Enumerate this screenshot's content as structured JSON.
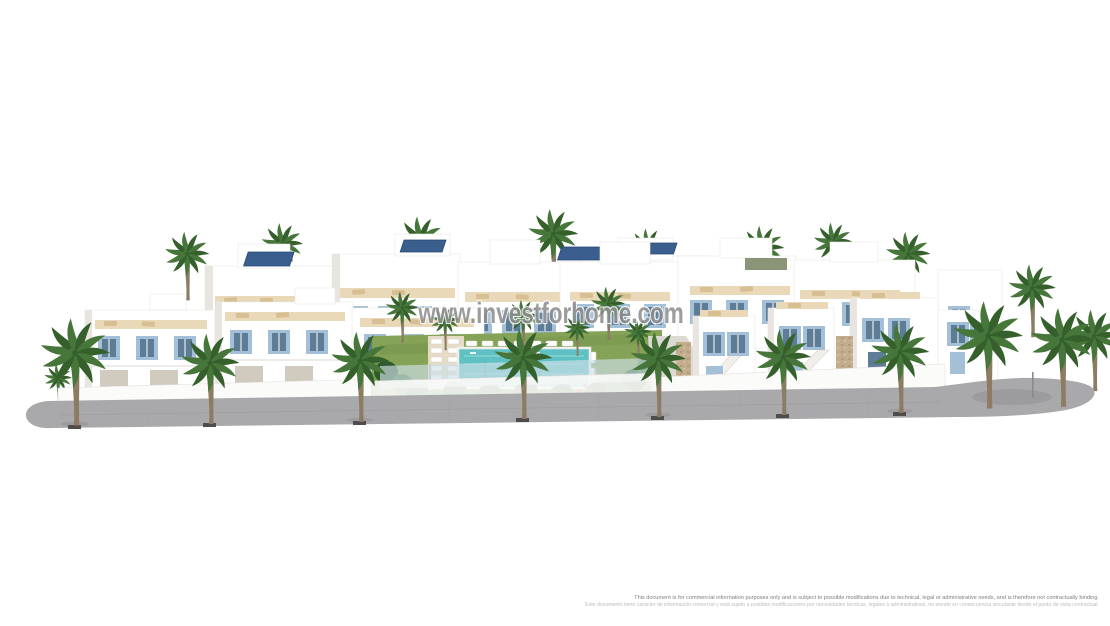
{
  "page": {
    "background": "#ffffff"
  },
  "watermark": {
    "text": "www.investforhome.com"
  },
  "disclaimer": {
    "en": "This document is for commercial information purposes only and is subject to possible modifications due to technical, legal or administrative needs, and is therefore not contractually binding.",
    "es": "Este documento tiene carácter de información comercial y está sujeto a posibles modificaciones por necesidades técnicas, legales o administrativas, no siendo en consecuencia vinculante desde el punto de vista contractual."
  },
  "scene": {
    "alt": "3D architectural rendering of a white Mediterranean residential complex: two-storey townhouses and detached villas with pale-blue shutters, rooftop terraces with sun loungers and solar panels, arranged around a central garden with a turquoise swimming pool, fronted by palm trees along a grey pavement on a white background",
    "colors": {
      "page": "#ffffff",
      "watermark": "#8f8f8f",
      "building": "#ffffff",
      "building_shadow": "#e8e5e0",
      "shutter": "#a3c0d8",
      "glass": "#5d7d97",
      "solar": "#3a5f8f",
      "terrace": "#ead9b8",
      "lounger": "#d8bf93",
      "lawn": "#85a356",
      "plant": "#477a3a",
      "plant_dark": "#2f5a2d",
      "pool": "#5fc1c4",
      "pool_light": "#9fdedd",
      "palm": "#46763a",
      "palm_dark": "#35602c",
      "trunk": "#8d7c64",
      "stone": "#c4ad8d",
      "road": "#a9a9ab",
      "wall": "#fbfbfa",
      "disclaimer_en": "#7e7e7e",
      "disclaimer_es": "#bcbcbc"
    }
  }
}
